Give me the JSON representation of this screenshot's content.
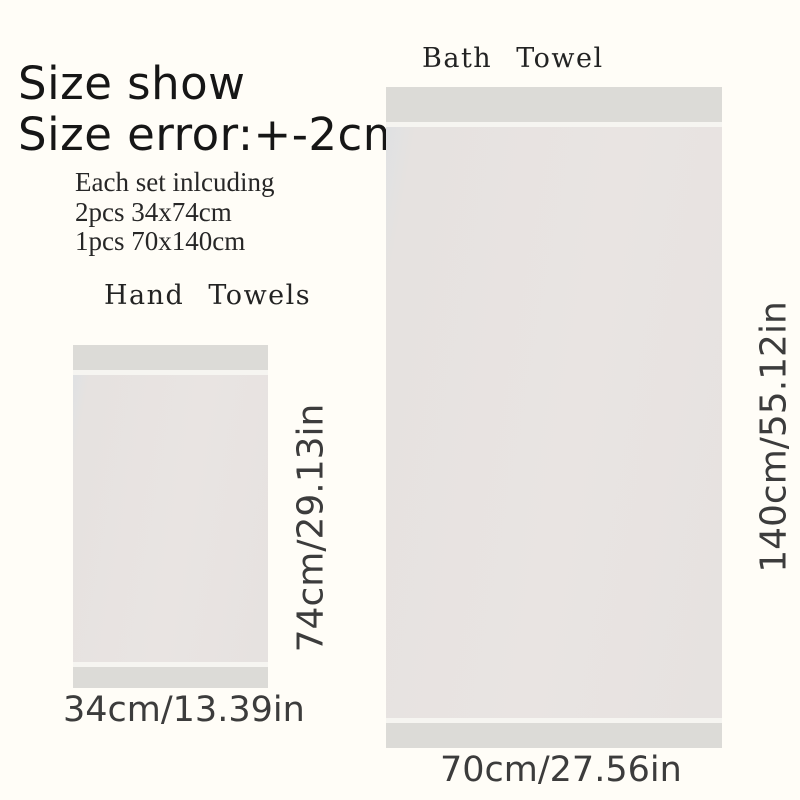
{
  "header": {
    "title_line1": "Size show",
    "title_line2": "Size error:+-2cm",
    "includes": [
      "Each set inlcuding",
      "2pcs 34x74cm",
      "1pcs 70x140cm"
    ]
  },
  "hand_towel": {
    "label": "Hand Towels",
    "height_label": "74cm/29.13in",
    "width_label": "34cm/13.39in",
    "size_cm": "34x74cm",
    "quantity": "2pcs"
  },
  "bath_towel": {
    "label": "Bath Towel",
    "height_label": "140cm/55.12in",
    "width_label": "70cm/27.56in",
    "size_cm": "70x140cm",
    "quantity": "1pcs"
  },
  "colors": {
    "bg": "#fffdf7",
    "title": "#161616",
    "body-text": "#272727",
    "label": "#232323",
    "dim": "#3c3c3c",
    "hem": "#dcdbd7",
    "sep": "#f6f5f1",
    "body-edge": "#dfe1e3",
    "body-main": "#e6e2e0",
    "body-main2": "#e9e4e2"
  }
}
